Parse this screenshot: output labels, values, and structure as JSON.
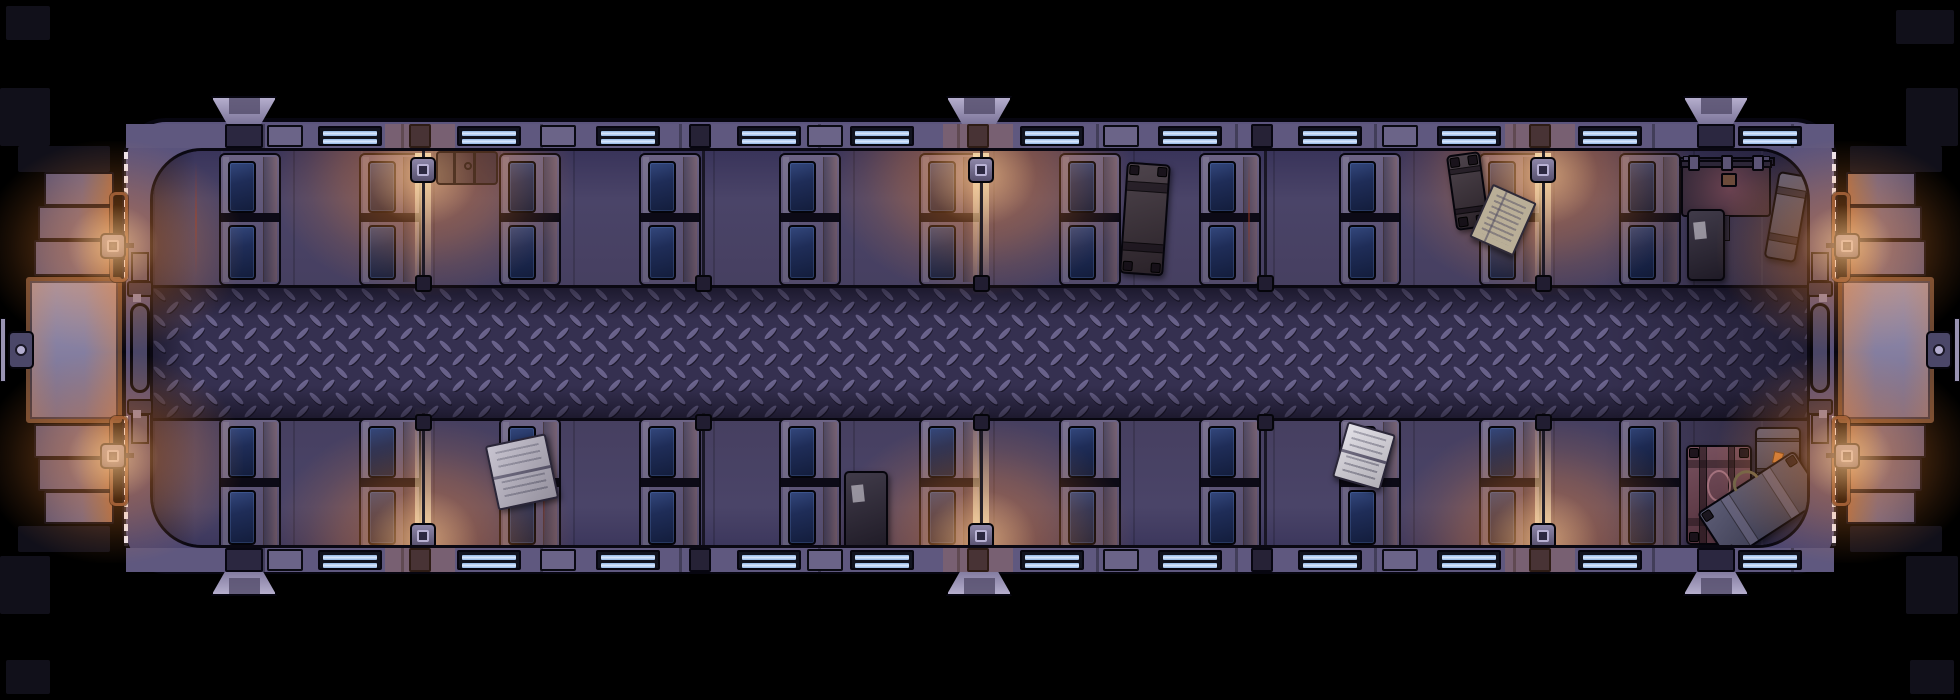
{
  "scene_title": "night-train-passenger-car-top-down-map",
  "palette": {
    "outside": "#000000",
    "slab": "#11101a",
    "hull": "#564f78",
    "hull_dark": "#4c4670",
    "outline": "#070610",
    "floor": "#423d5b",
    "floor_dark": "#39345a",
    "aisle_base": "#353050",
    "aisle_lens": "#7b73a0",
    "aisle_lens_shadow": "#1e1a2e",
    "wall_strip": "#5f587f",
    "wall_post": "#6b6488",
    "wall_block": "#2b2740",
    "window_glass_dark": "#11131f",
    "window_bar": "#8fb4e4",
    "window_bar_hi": "#ddeaff",
    "booth_frame": "#5a5274",
    "booth_frame_hi": "#8f88aa",
    "cushion": "#1f2d58",
    "cushion_hi": "#33477c",
    "cushion_dark": "#131d3c",
    "lamp_metal": "#57506e",
    "lamp_glow": "255,140,50",
    "lamp_beam": "255,225,175",
    "steel_plate": "#9a94b3",
    "bronze": "#6d4832",
    "copper_pipe": "#7a4c36",
    "step": "#5e5677",
    "step_warm": "#a06a4e",
    "door_pill": "#4a4666",
    "knob": "#4b4768",
    "knob_ring": "#b3adcf",
    "door_dash": "#ece8f4",
    "vent_light": "#b5aecd",
    "vent_mid": "#7b7499",
    "vent_inner": "#57506f",
    "trunk_dark": "#2b2535",
    "trunk_brown": "#3a2f38",
    "trunk_maroon": "#6a3e4d",
    "trunk_slate": "#4a4a66",
    "lid_maroon": "#6b4250",
    "pages_grey": "#b5b0c0",
    "pages_white": "#d9d6df",
    "pages_tan": "#b9ae97",
    "tag_orange": "#c97b3a",
    "rust": "#964230"
  },
  "layout": {
    "stage": {
      "w": 1960,
      "h": 700
    },
    "hull": {
      "x": 122,
      "y": 118,
      "w": 1716,
      "h": 456,
      "r": 44
    },
    "interior": {
      "x": 150,
      "y": 148,
      "w": 1660,
      "h": 400,
      "r": 52
    },
    "aisle": {
      "y": 285,
      "h": 130
    },
    "wall_strip_top": {
      "y": 124,
      "h": 24
    },
    "wall_strip_bottom": {
      "y": 548,
      "h": 24
    }
  },
  "vents": {
    "centers_x": [
      244,
      979,
      1716
    ],
    "w": 66,
    "h": 30
  },
  "windows": {
    "xs": [
      318,
      457,
      596,
      737,
      850,
      1020,
      1158,
      1298,
      1437,
      1578,
      1738
    ],
    "w": 64,
    "h": 20
  },
  "wall_posts": {
    "xs": [
      285,
      558,
      825,
      1121,
      1400
    ],
    "w": 36
  },
  "wall_blocks": {
    "xs": [
      244,
      1716
    ],
    "w": 38
  },
  "booths": {
    "cushion_xs": [
      222,
      362,
      502,
      642,
      782,
      922,
      1062,
      1202,
      1342,
      1482,
      1622
    ],
    "frame_w": 62,
    "frame_h": 133,
    "top_y": 150,
    "bottom_y": 415
  },
  "wall_lamps": [
    {
      "x": 420,
      "lit": true
    },
    {
      "x": 700,
      "lit": false
    },
    {
      "x": 978,
      "lit": true
    },
    {
      "x": 1262,
      "lit": false
    },
    {
      "x": 1540,
      "lit": true
    }
  ],
  "end_lamps": [
    {
      "end": "left",
      "band": "top"
    },
    {
      "end": "left",
      "band": "bottom"
    },
    {
      "end": "right",
      "band": "top"
    },
    {
      "end": "right",
      "band": "bottom"
    }
  ],
  "vestibules": [
    "left",
    "right"
  ],
  "rust_streaks": [
    {
      "x": 192,
      "y": 158,
      "h": 115
    },
    {
      "x": 540,
      "y": 425,
      "h": 115
    },
    {
      "x": 1245,
      "y": 155,
      "h": 118
    }
  ],
  "luggage": [
    {
      "type": "trunk_outline",
      "x": 433,
      "y": 148,
      "w": 62,
      "h": 34,
      "rot": 0
    },
    {
      "type": "trunk",
      "x": 1120,
      "y": 160,
      "w": 44,
      "h": 112,
      "rot": 4,
      "body": "trunk_brown",
      "straps": "h",
      "corners": true
    },
    {
      "type": "trunk",
      "x": 1448,
      "y": 150,
      "w": 34,
      "h": 76,
      "rot": -8,
      "body": "trunk_brown",
      "straps": "h",
      "corners": true
    },
    {
      "type": "book_closed",
      "x": 1476,
      "y": 188,
      "w": 48,
      "h": 58,
      "rot": 24,
      "pages": "pages_tan"
    },
    {
      "type": "rail",
      "x": 1676,
      "y": 154,
      "w": 96,
      "h": 9
    },
    {
      "type": "bigtrunk_lid",
      "x": 1678,
      "y": 162,
      "w": 90,
      "h": 52
    },
    {
      "type": "trunk",
      "x": 1684,
      "y": 206,
      "w": 38,
      "h": 72,
      "rot": 0,
      "body": "trunk_dark",
      "label": true
    },
    {
      "type": "trunk",
      "x": 1768,
      "y": 170,
      "w": 32,
      "h": 88,
      "rot": 10,
      "body": "trunk_slate",
      "straps": "h"
    },
    {
      "type": "book_open",
      "x": 488,
      "y": 436,
      "w": 62,
      "h": 66,
      "rot": -12,
      "pages": "pages_grey"
    },
    {
      "type": "trunk",
      "x": 841,
      "y": 468,
      "w": 44,
      "h": 80,
      "rot": 0,
      "body": "trunk_dark",
      "label": true
    },
    {
      "type": "book_open",
      "x": 1336,
      "y": 424,
      "w": 50,
      "h": 58,
      "rot": 16,
      "pages": "pages_white"
    },
    {
      "type": "trunk",
      "x": 1683,
      "y": 442,
      "w": 66,
      "h": 100,
      "rot": 0,
      "body": "trunk_maroon",
      "straps": "grid",
      "oval": true,
      "corners": true
    },
    {
      "type": "trunk",
      "x": 1752,
      "y": 424,
      "w": 46,
      "h": 58,
      "rot": 0,
      "body": "trunk_slate",
      "straps": "h",
      "tag": true
    },
    {
      "type": "suitcase",
      "x": 1700,
      "y": 474,
      "w": 116,
      "h": 58,
      "rot": -33,
      "body": "trunk_slate",
      "handle": true
    }
  ],
  "bay_shadow": {
    "x": 1600,
    "w": 210
  },
  "outside_slabs": [
    {
      "x": 18,
      "y": 146,
      "w": 92,
      "h": 26
    },
    {
      "x": 18,
      "y": 526,
      "w": 92,
      "h": 26
    },
    {
      "x": 0,
      "y": 88,
      "w": 50,
      "h": 58
    },
    {
      "x": 0,
      "y": 556,
      "w": 50,
      "h": 58
    },
    {
      "x": 1850,
      "y": 146,
      "w": 92,
      "h": 26
    },
    {
      "x": 1850,
      "y": 526,
      "w": 92,
      "h": 26
    },
    {
      "x": 1906,
      "y": 88,
      "w": 52,
      "h": 58
    },
    {
      "x": 1906,
      "y": 556,
      "w": 52,
      "h": 58
    },
    {
      "x": 6,
      "y": 6,
      "w": 44,
      "h": 34
    },
    {
      "x": 1896,
      "y": 10,
      "w": 58,
      "h": 34
    },
    {
      "x": 6,
      "y": 660,
      "w": 44,
      "h": 34
    },
    {
      "x": 1910,
      "y": 660,
      "w": 44,
      "h": 34
    }
  ]
}
